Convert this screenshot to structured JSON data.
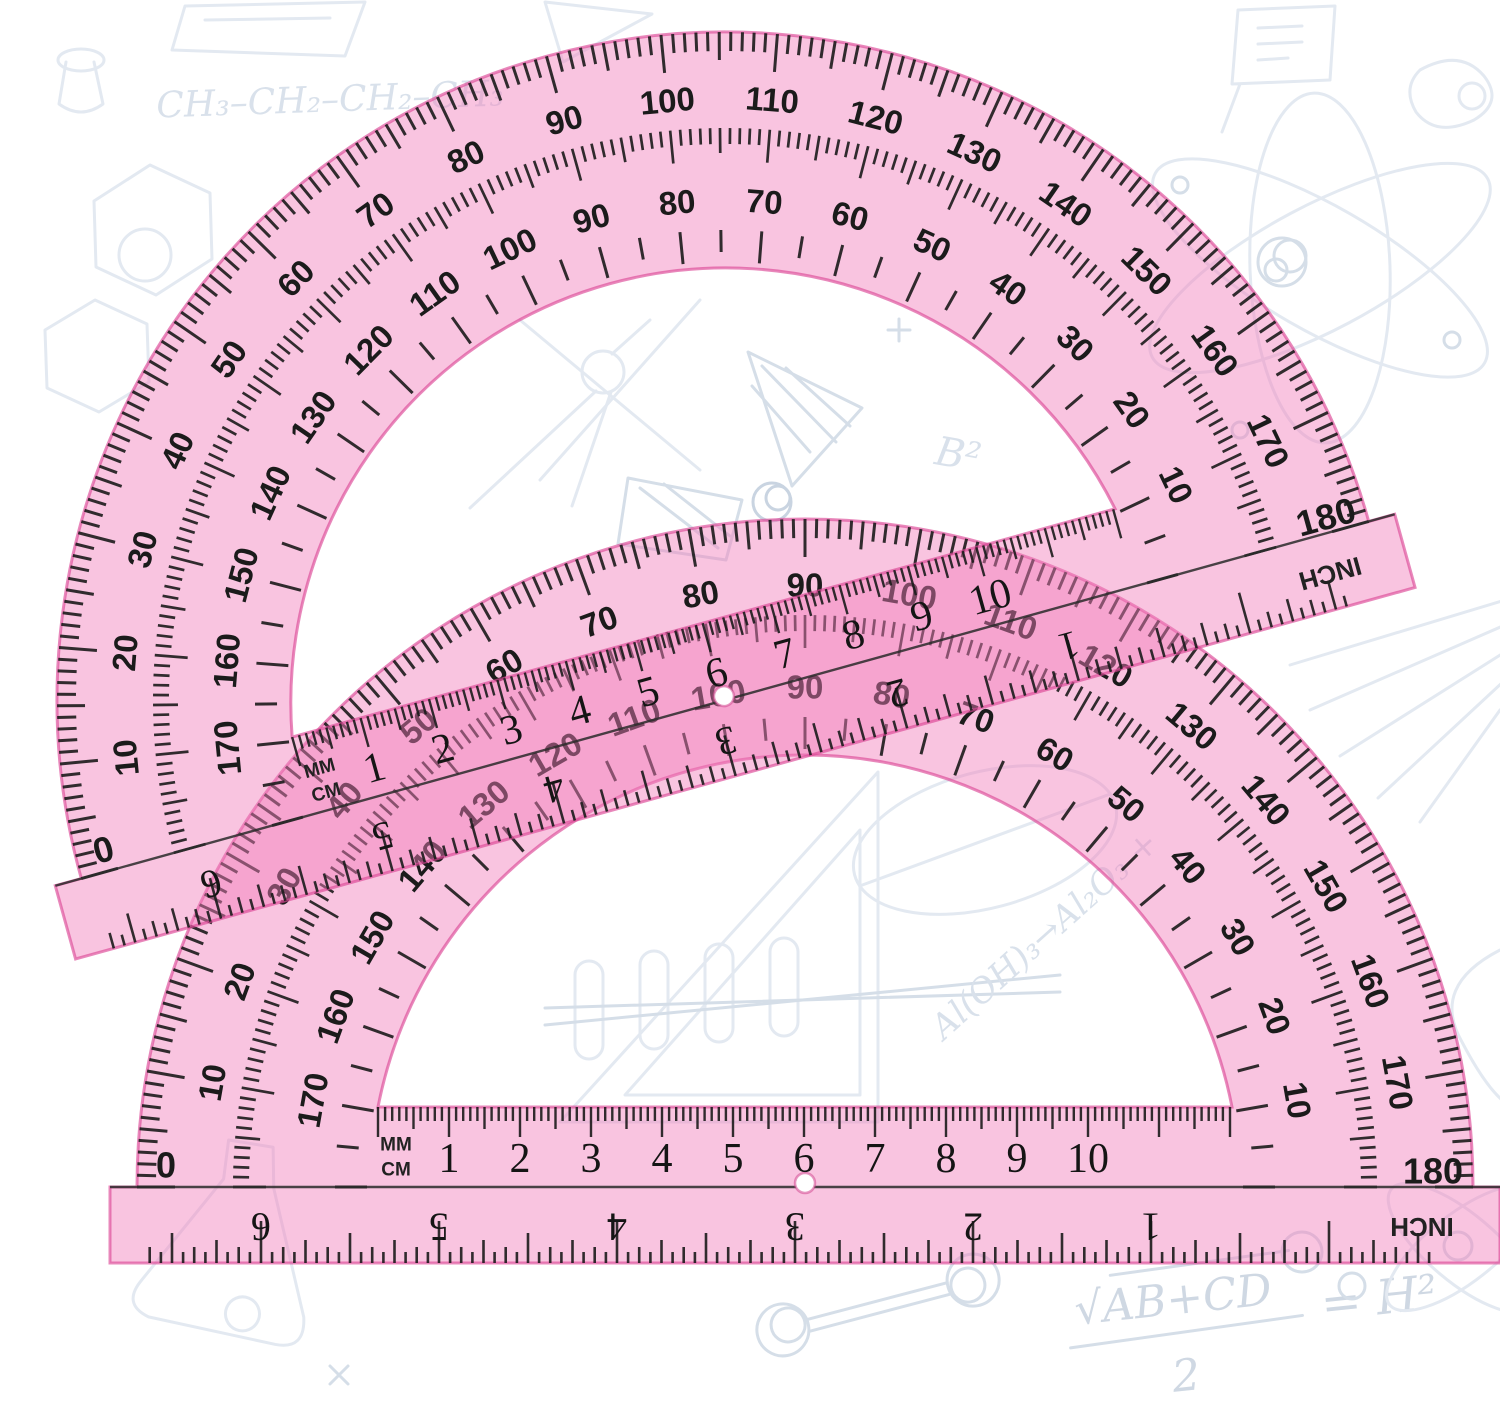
{
  "scene": {
    "width": 1500,
    "height": 1410,
    "background": "#ffffff"
  },
  "palette": {
    "plastic_fill": "rgba(243,126,188,0.46)",
    "plastic_edge": "rgba(219,72,151,0.65)",
    "tick_color": "#1b1b1b",
    "hole_stroke": "rgba(214,80,150,0.6)",
    "doodle_light": "#e3e9f1",
    "doodle_medium": "#d5dee8"
  },
  "protractor": {
    "outer_labels": [
      "10",
      "20",
      "30",
      "40",
      "50",
      "60",
      "70",
      "80",
      "90",
      "100",
      "110",
      "120",
      "130",
      "140",
      "150",
      "160",
      "170"
    ],
    "inner_labels": [
      "10",
      "20",
      "30",
      "40",
      "50",
      "60",
      "70",
      "80",
      "90",
      "100",
      "110",
      "120",
      "130",
      "140",
      "150",
      "160",
      "170"
    ],
    "end_labels": {
      "left": "0",
      "right": "180"
    },
    "cm_labels": [
      "1",
      "2",
      "3",
      "4",
      "5",
      "6",
      "7",
      "8",
      "9",
      "10"
    ],
    "inch_labels": [
      "1",
      "2",
      "3",
      "4",
      "5",
      "6"
    ],
    "unit_labels": {
      "mm": "MM",
      "cm": "CM",
      "inch": "INCH"
    }
  },
  "instances": [
    {
      "name": "protractor-bottom",
      "x": 805,
      "y": 1187,
      "rotation": 0
    },
    {
      "name": "protractor-top",
      "x": 725,
      "y": 700,
      "rotation": -15.5
    }
  ],
  "doodles": {
    "alkane_formula": "CH₃–CH₂–CH₂–CH₃",
    "b_squared": "B²",
    "aloh_formula": "Al(OH)₃→Al₂O₃ +",
    "sqrt_formula": {
      "radicand": "√AB+CD",
      "denominator": "2",
      "rhs": "= H²"
    }
  }
}
